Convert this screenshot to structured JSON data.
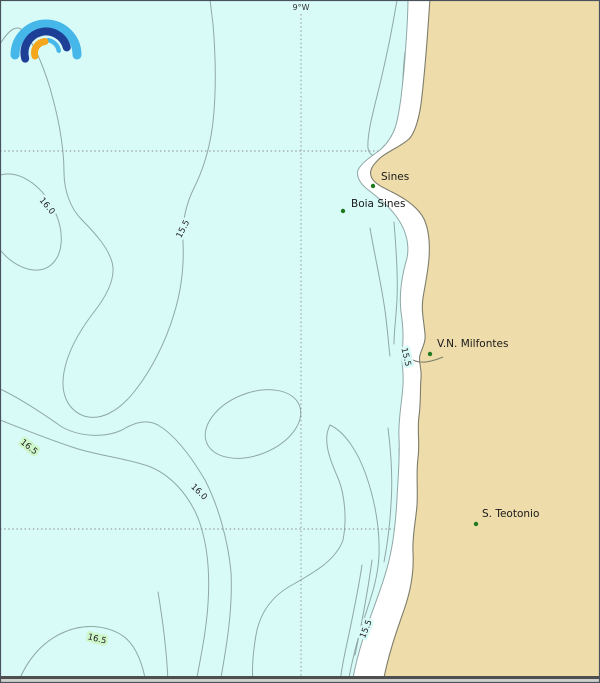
{
  "map": {
    "graticule": {
      "lon_label": "9°W"
    },
    "places": [
      {
        "name": "Sines"
      },
      {
        "name": "Boia Sines"
      },
      {
        "name": "V.N. Milfontes"
      },
      {
        "name": "S. Teotonio"
      }
    ],
    "isotherm_labels": [
      {
        "value": "16.0"
      },
      {
        "value": "15.5"
      },
      {
        "value": "15.5"
      },
      {
        "value": "16.5"
      },
      {
        "value": "16.0"
      },
      {
        "value": "16.5"
      },
      {
        "value": "15.5"
      }
    ],
    "colors": {
      "sea": "#d9fbf8",
      "land": "#eedcab",
      "band_high": "#cdf6c9",
      "band_low": "#ffffff",
      "contour": "#8fa8a6",
      "coastline": "#7d7d6d",
      "place_dot": "#1f7a1f",
      "logo_blue": "#45b7e8",
      "logo_dark_blue": "#1d3f96",
      "logo_orange": "#f4a71d",
      "frame": "#49525c"
    }
  }
}
